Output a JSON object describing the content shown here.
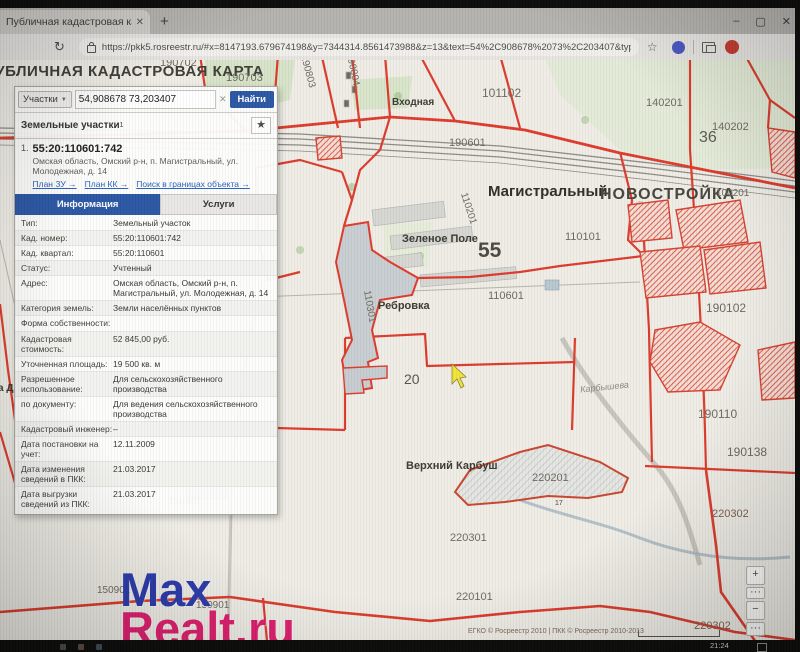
{
  "browser": {
    "tab_title": "Публичная кадастровая карта",
    "tab_close_icon": "✕",
    "new_tab": "+",
    "reload_icon": "↻",
    "url": "https://pkk5.rosreestr.ru/#x=8147193.679674198&y=7344314.8561473988&z=13&text=54%2C908678%2073%2C203407&type=1&app=search&opened…",
    "bookmark_star_icon": "☆",
    "window_controls": {
      "minimize": "–",
      "maximize": "▢",
      "close": "✕"
    }
  },
  "site": {
    "title": "ПУБЛИЧНАЯ КАДАСТРОВАЯ КАРТА"
  },
  "search": {
    "type_selector": "Участки",
    "caret_icon": "▼",
    "query": "54,908678 73,203407",
    "clear_icon": "✕",
    "find_button": "Найти",
    "results_header": "Земельные участки",
    "results_sup": "1",
    "star_icon": "★"
  },
  "parcel": {
    "index": "1.",
    "number": "55:20:110601:742",
    "address": "Омская область, Омский р-н, п. Магистральный, ул. Молодежная, д. 14",
    "links": [
      "План ЗУ →",
      "План КК →",
      "Поиск в границах объекта →"
    ],
    "tabs": [
      "Информация",
      "Услуги"
    ],
    "info_rows": [
      {
        "label": "Тип:",
        "value": "Земельный участок"
      },
      {
        "label": "Кад. номер:",
        "value": "55:20:110601:742"
      },
      {
        "label": "Кад. квартал:",
        "value": "55:20:110601"
      },
      {
        "label": "Статус:",
        "value": "Учтенный"
      },
      {
        "label": "Адрес:",
        "value": "Омская область, Омский р-н, п. Магистральный, ул. Молодежная, д. 14"
      },
      {
        "label": "Категория земель:",
        "value": "Земли населённых пунктов"
      },
      {
        "label": "Форма собственности:",
        "value": ""
      },
      {
        "label": "Кадастровая стоимость:",
        "value": "52 845,00 руб."
      },
      {
        "label": "Уточненная площадь:",
        "value": "19 500 кв. м"
      },
      {
        "label": "Разрешенное использование:",
        "value": "Для сельскохозяйственного производства"
      },
      {
        "label": "по документу:",
        "value": "Для ведения сельскохозяйственного производства"
      },
      {
        "label": "Кадастровый инженер:",
        "value": "–"
      },
      {
        "label": "Дата постановки на учет:",
        "value": "12.11.2009"
      },
      {
        "label": "Дата изменения сведений в ПКК:",
        "value": "21.03.2017"
      },
      {
        "label": "Дата выгрузки сведений из ПКК:",
        "value": "21.03.2017"
      }
    ]
  },
  "map": {
    "labels": [
      {
        "text": "190702",
        "x": 160,
        "y": -3,
        "s": 11
      },
      {
        "text": "190703",
        "x": 226,
        "y": 12,
        "s": 11
      },
      {
        "text": "190803",
        "x": 291,
        "y": 6,
        "s": 10,
        "r": 75
      },
      {
        "text": "190804",
        "x": 336,
        "y": 4,
        "s": 10,
        "r": 78
      },
      {
        "text": "101102",
        "x": 482,
        "y": 26,
        "s": 12
      },
      {
        "text": "Входная",
        "x": 392,
        "y": 37,
        "s": 10,
        "b": 1,
        "c": "#3c3c36"
      },
      {
        "text": "190601",
        "x": 449,
        "y": 77,
        "s": 11
      },
      {
        "text": "140201",
        "x": 646,
        "y": 37,
        "s": 11
      },
      {
        "text": "140202",
        "x": 712,
        "y": 61,
        "s": 11
      },
      {
        "text": "36",
        "x": 699,
        "y": 69,
        "s": 16,
        "c": "#5c5c54"
      },
      {
        "text": "Магистральный",
        "x": 488,
        "y": 123,
        "s": 15,
        "b": 1,
        "c": "#2e2e28"
      },
      {
        "text": "НОВОСТРОЙКА",
        "x": 600,
        "y": 126,
        "s": 16,
        "b": 1,
        "c": "#45453c",
        "ls": 1
      },
      {
        "text": "100201",
        "x": 716,
        "y": 128,
        "s": 10
      },
      {
        "text": "110201",
        "x": 452,
        "y": 143,
        "s": 10,
        "r": 72
      },
      {
        "text": "Зеленое Поле",
        "x": 402,
        "y": 173,
        "s": 11,
        "b": 1,
        "c": "#3a3a32"
      },
      {
        "text": "55",
        "x": 478,
        "y": 179,
        "s": 21,
        "b": 1,
        "c": "#4a4a42"
      },
      {
        "text": "110101",
        "x": 565,
        "y": 171,
        "s": 11
      },
      {
        "text": "110601",
        "x": 488,
        "y": 230,
        "s": 11
      },
      {
        "text": "Ребровка",
        "x": 378,
        "y": 240,
        "s": 11,
        "b": 1,
        "c": "#3a3a32"
      },
      {
        "text": "110301",
        "x": 353,
        "y": 241,
        "s": 10,
        "r": 80
      },
      {
        "text": "190102",
        "x": 706,
        "y": 241,
        "s": 12
      },
      {
        "text": "20",
        "x": 404,
        "y": 311,
        "s": 14,
        "c": "#55554d"
      },
      {
        "text": "Карбышева",
        "x": 580,
        "y": 322,
        "s": 9,
        "i": 1,
        "c": "#8c8c80",
        "r": -6
      },
      {
        "text": "а До",
        "x": -2,
        "y": 323,
        "s": 10,
        "b": 1,
        "c": "#3a3a32"
      },
      {
        "text": "190110",
        "x": 698,
        "y": 347,
        "s": 12
      },
      {
        "text": "190138",
        "x": 727,
        "y": 385,
        "s": 12
      },
      {
        "text": "Верхний Карбуш",
        "x": 406,
        "y": 400,
        "s": 11,
        "b": 1,
        "c": "#3a3a32"
      },
      {
        "text": "220201",
        "x": 532,
        "y": 412,
        "s": 11
      },
      {
        "text": "150901",
        "x": 168,
        "y": 436,
        "s": 10
      },
      {
        "text": "17",
        "x": 555,
        "y": 440,
        "s": 7,
        "c": "#44443c"
      },
      {
        "text": "220302",
        "x": 712,
        "y": 448,
        "s": 11,
        "c": "#7e6156"
      },
      {
        "text": "220301",
        "x": 450,
        "y": 472,
        "s": 11
      },
      {
        "text": "150901",
        "x": 97,
        "y": 525,
        "s": 10
      },
      {
        "text": "150901",
        "x": 196,
        "y": 540,
        "s": 10
      },
      {
        "text": "220101",
        "x": 456,
        "y": 531,
        "s": 11
      },
      {
        "text": "220302",
        "x": 694,
        "y": 560,
        "s": 11,
        "c": "#7e6156"
      }
    ],
    "controls": [
      {
        "name": "zoom-in-button",
        "glyph": "+",
        "y": 506,
        "h": 17
      },
      {
        "name": "zoom-options-button",
        "glyph": "···",
        "y": 527,
        "h": 10
      },
      {
        "name": "zoom-out-button",
        "glyph": "−",
        "y": 541,
        "h": 17
      },
      {
        "name": "more-tools-button",
        "glyph": "···",
        "y": 562,
        "h": 12
      }
    ],
    "attribution": "ЕГКО © Росреестр 2010 | ПКК © Росреестр 2010-2013"
  },
  "watermark": {
    "line1": "Max",
    "line2": "Realt.ru"
  },
  "taskbar": {
    "time": "21:24"
  }
}
